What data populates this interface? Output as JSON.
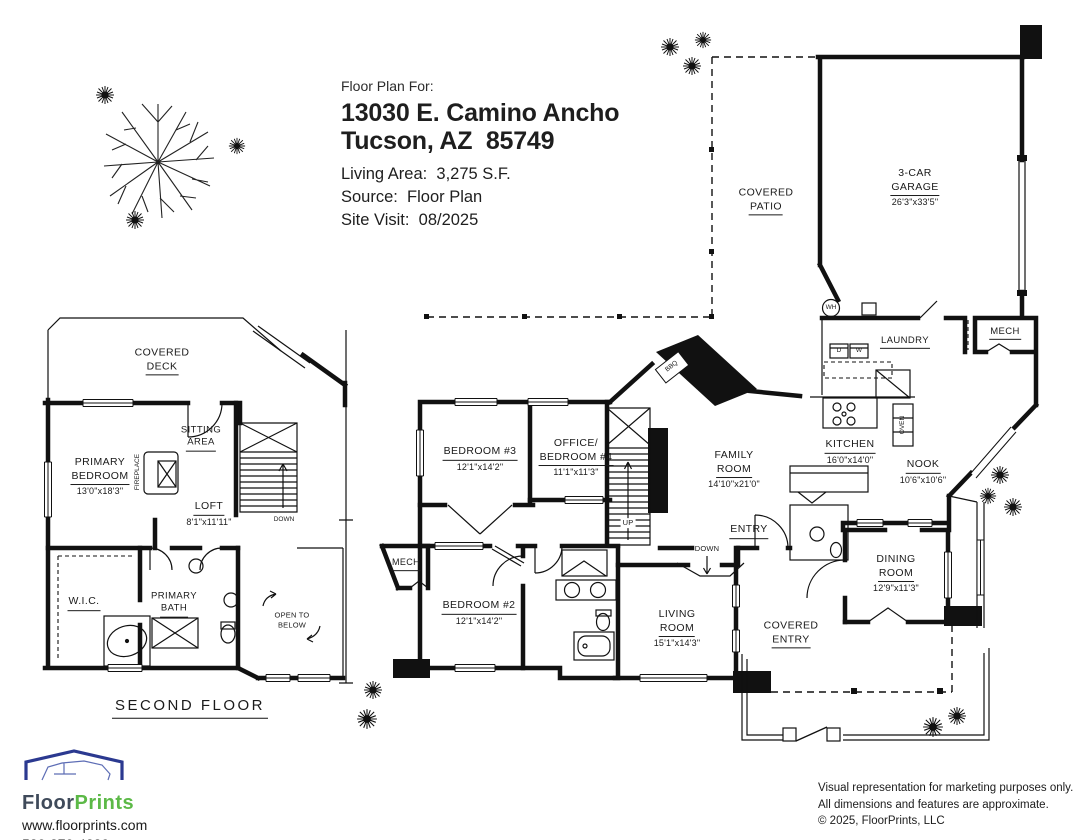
{
  "title_block": {
    "prefix": "Floor Plan For:",
    "address_line1": "13030 E. Camino Ancho",
    "address_line2": "Tucson, AZ  85749",
    "living_area": "Living Area:  3,275 S.F.",
    "source": "Source:  Floor Plan",
    "site_visit": "Site Visit:  08/2025"
  },
  "second_floor": {
    "floor_title": "SECOND FLOOR",
    "labels": {
      "covered_deck": {
        "l1": "COVERED",
        "l2": "DECK"
      },
      "sitting_area": {
        "l1": "SITTING",
        "l2": "AREA"
      },
      "primary_bedroom": {
        "l1": "PRIMARY",
        "l2": "BEDROOM",
        "dims": "13'0\"x18'3\""
      },
      "fireplace": {
        "l1": "FIREPLACE"
      },
      "loft": {
        "l1": "LOFT",
        "dims": "8'1\"x11'11\""
      },
      "down": {
        "l1": "DOWN"
      },
      "wic": {
        "l1": "W.I.C."
      },
      "primary_bath": {
        "l1": "PRIMARY",
        "l2": "BATH"
      },
      "open_to_below": {
        "l1": "OPEN TO",
        "l2": "BELOW"
      }
    }
  },
  "first_floor": {
    "labels": {
      "covered_patio": {
        "l1": "COVERED",
        "l2": "PATIO"
      },
      "garage": {
        "l1": "3-CAR",
        "l2": "GARAGE",
        "dims": "26'3\"x33'5\""
      },
      "laundry": {
        "l1": "LAUNDRY"
      },
      "mech_right": {
        "l1": "MECH"
      },
      "mech_left": {
        "l1": "MECH"
      },
      "wh": {
        "l1": "WH"
      },
      "dryer": {
        "l1": "D"
      },
      "washer": {
        "l1": "W"
      },
      "oven": {
        "l1": "OVEN"
      },
      "bbq": {
        "l1": "BBQ"
      },
      "kitchen": {
        "l1": "KITCHEN",
        "dims": "16'0\"x14'0\""
      },
      "nook": {
        "l1": "NOOK",
        "dims": "10'6\"x10'6\""
      },
      "family_room": {
        "l1": "FAMILY",
        "l2": "ROOM",
        "dims": "14'10\"x21'0\""
      },
      "entry": {
        "l1": "ENTRY"
      },
      "up": {
        "l1": "UP"
      },
      "down": {
        "l1": "DOWN"
      },
      "bedroom3": {
        "l1": "BEDROOM #3",
        "dims": "12'1\"x14'2\""
      },
      "office_bedroom4": {
        "l1": "OFFICE/",
        "l2": "BEDROOM #4",
        "dims": "11'1\"x11'3\""
      },
      "bedroom2": {
        "l1": "BEDROOM #2",
        "dims": "12'1\"x14'2\""
      },
      "living_room": {
        "l1": "LIVING",
        "l2": "ROOM",
        "dims": "15'1\"x14'3\""
      },
      "covered_entry": {
        "l1": "COVERED",
        "l2": "ENTRY"
      },
      "dining_room": {
        "l1": "DINING",
        "l2": "ROOM",
        "dims": "12'9\"x11'3\""
      }
    }
  },
  "footer": {
    "logo_floor": "Floor",
    "logo_prints": "Prints",
    "website": "www.floorprints.com",
    "phone": "520-270-4230",
    "disclaimer_line1": "Visual representation for marketing purposes only.",
    "disclaimer_line2": "All dimensions and features are approximate.",
    "copyright": "© 2025, FloorPrints, LLC"
  },
  "colors": {
    "logo_floor": "#3f4a5a",
    "logo_prints": "#5cb947",
    "logo_roof": "#2b3990",
    "linework": "#111111"
  }
}
